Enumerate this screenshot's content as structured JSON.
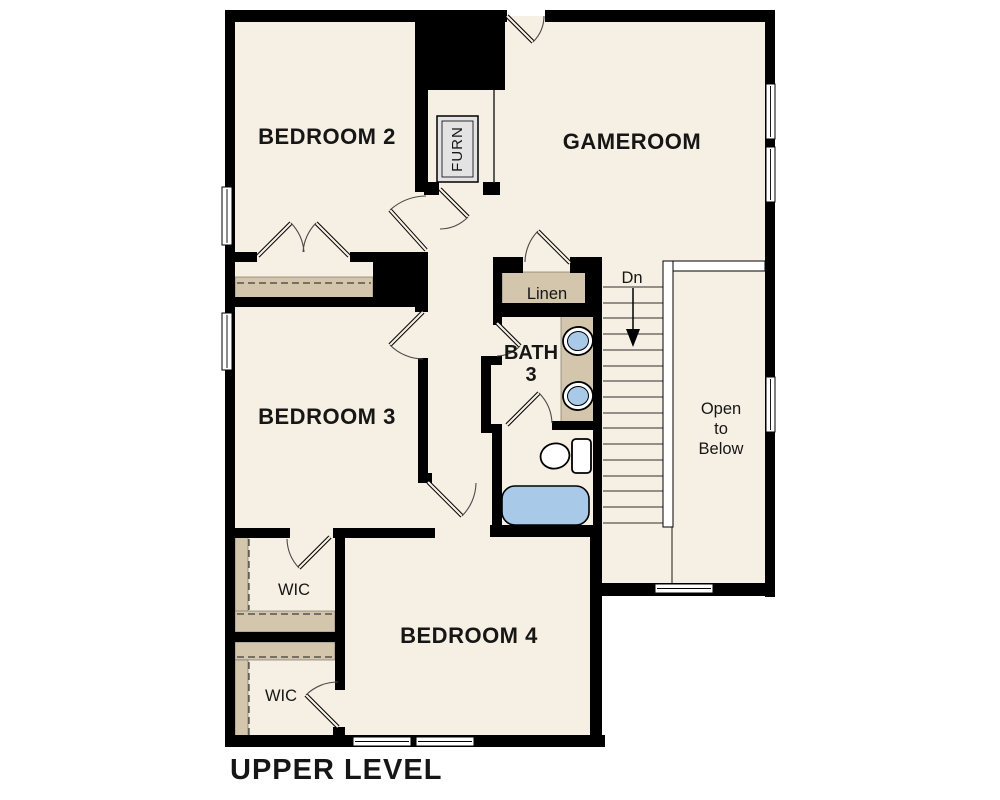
{
  "title": "UPPER LEVEL",
  "rooms": {
    "bedroom2": "BEDROOM 2",
    "gameroom": "GAMEROOM",
    "bedroom3": "BEDROOM 3",
    "bedroom4": "BEDROOM 4",
    "bath3_line1": "BATH",
    "bath3_line2": "3",
    "linen": "Linen",
    "wic1": "WIC",
    "wic2": "WIC",
    "furnace": "FURN",
    "stairs_direction": "Dn",
    "open_below_line1": "Open",
    "open_below_line2": "to",
    "open_below_line3": "Below"
  },
  "colors": {
    "wall": "#000000",
    "floor": "#f6efe3",
    "shelf": "#d3c6ad",
    "blue": "#a9c9e9",
    "gray": "#e3e3e3",
    "bg": "#ffffff",
    "ink": "#161616"
  }
}
